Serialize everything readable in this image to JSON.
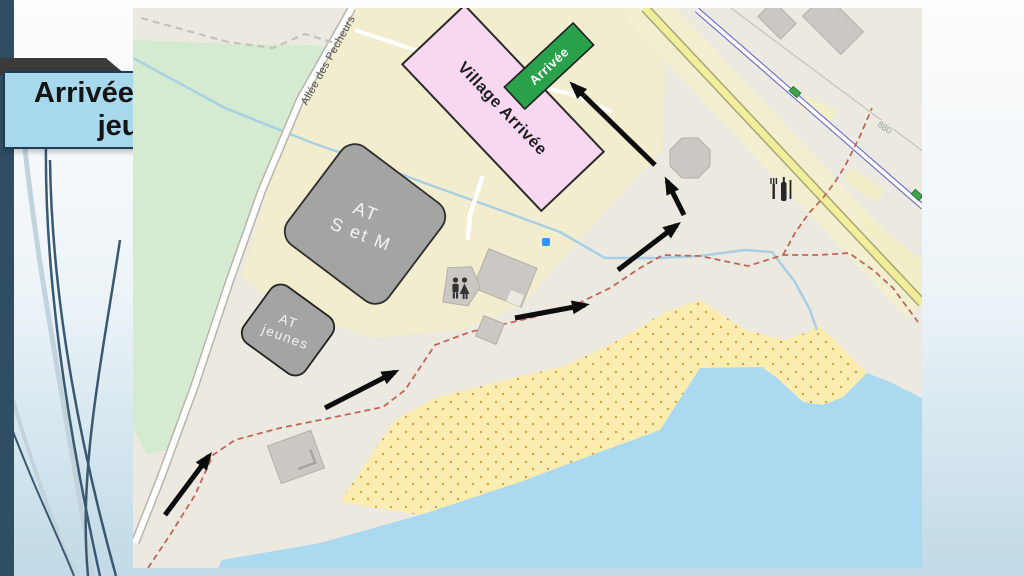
{
  "slide": {
    "title": "Arrivée courses jeunes"
  },
  "map": {
    "street_label": "Allée des Pecheurs",
    "contour_label": "880",
    "village_box": {
      "label": "Village Arrivée"
    },
    "arrival_box": {
      "label": "Arrivée"
    },
    "at_main": {
      "line1": "AT",
      "line2": "S et M"
    },
    "at_youth": {
      "line1": "AT",
      "line2": "jeunes"
    },
    "icons": {
      "wc": "restroom man and woman figures",
      "picnic": "fork knife and bottle utensils",
      "cycleway_marker": "small green route markers"
    },
    "route": {
      "arrow_count": 6,
      "arrow_color": "#0D0D0D"
    },
    "colors": {
      "pink": "#F8D7F0",
      "green_label": "#2AA24B",
      "at_gray": "#A4A4A2",
      "park": "#D5EBD1",
      "camp_yellow": "#F1EDCE",
      "road_yellow": "#F0EE9A",
      "beach": "#FBEDB0",
      "water": "#ABD9F0",
      "trail_red": "#C0655A",
      "title_box": "#A8D8EC",
      "accent_bar": "#2F4D63",
      "banner": "#3B3B3B",
      "blue_dot": "#2E95F0"
    }
  }
}
